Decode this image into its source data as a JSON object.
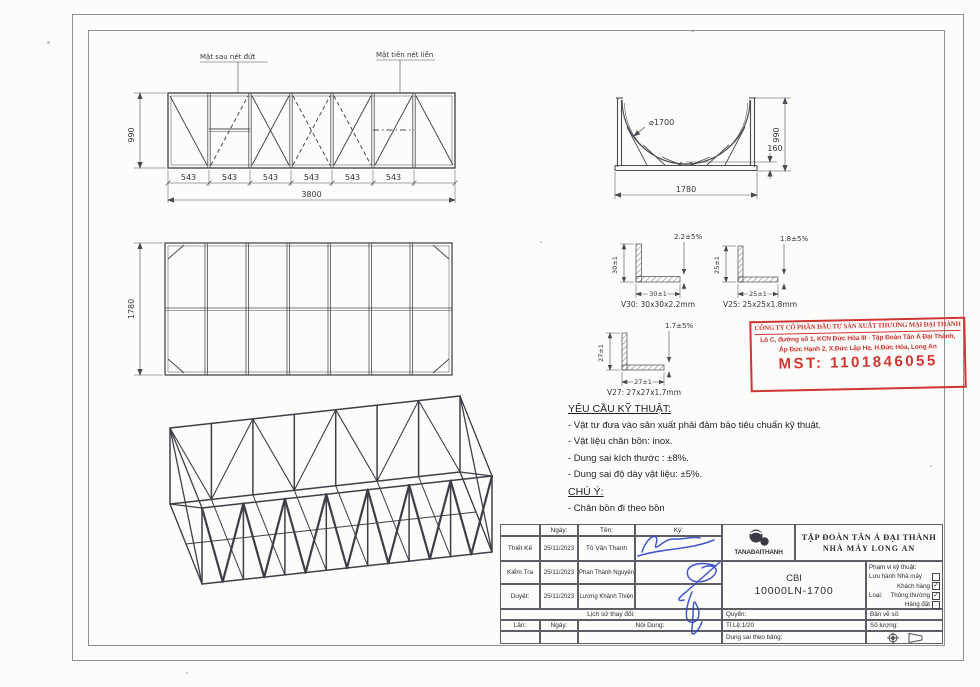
{
  "front_view": {
    "label_back_face": "Mặt sau nét đứt",
    "label_front_face": "Mặt tiền nét liền",
    "dim_height": "990",
    "dim_bays": [
      "543",
      "543",
      "543",
      "543",
      "543",
      "543"
    ],
    "dim_total": "3800"
  },
  "cradle_view": {
    "dim_diameter": "⌀1700",
    "dim_height": "990",
    "dim_offset": "160",
    "dim_width": "1780"
  },
  "plan_view": {
    "dim_depth": "1780"
  },
  "angle_details": {
    "v30": {
      "caption": "V30: 30x30x2.2mm",
      "dim_vertical": "30±1",
      "dim_horizontal": "30±1",
      "dim_thickness": "2.2±5%"
    },
    "v25": {
      "caption": "V25: 25x25x1.8mm",
      "dim_vertical": "25±1",
      "dim_horizontal": "25±1",
      "dim_thickness": "1.8±5%"
    },
    "v27": {
      "caption": "V27: 27x27x1.7mm",
      "dim_vertical": "27±1",
      "dim_horizontal": "27±1",
      "dim_thickness": "1.7±5%"
    }
  },
  "stamp": {
    "company": "CÔNG TY CỔ PHẦN ĐẦU TƯ SẢN XUẤT THƯƠNG MẠI ĐẠI THÀNH",
    "address_line1": "Lô C, đường số 1, KCN Đức Hòa III - Tập Đoàn Tân Á Đại Thành,",
    "address_line2": "Ấp Đức Hạnh 2, X.Đức Lập Hạ, H.Đức Hòa, Long An",
    "tax_id": "MST: 1101846055",
    "color": "#cf3531"
  },
  "tech_requirements": {
    "title": "YÊU CẦU KỸ THUẬT:",
    "items": [
      "- Vật tư đưa vào sản xuất phải đảm bảo tiêu chuẩn kỹ thuật.",
      "- Vật liệu chân bồn: inox.",
      "- Dung sai kích thước : ±8%.",
      "- Dung sai độ dày vật liệu: ±5%."
    ],
    "note_title": "CHÚ Ý:",
    "note_item": "- Chân bồn đi theo bồn"
  },
  "title_block": {
    "columns": {
      "date": "Ngày:",
      "name": "Tên:",
      "sign": "Ký:"
    },
    "approvals": [
      {
        "role": "Thiết Kế",
        "date": "25/11/2023",
        "name": "Tô Văn Thanh"
      },
      {
        "role": "Kiểm Tra",
        "date": "25/11/2023",
        "name": "Phan Thành Nguyên"
      },
      {
        "role": "Duyệt:",
        "date": "25/11/2023",
        "name": "Lương Khánh Thiện"
      }
    ],
    "history_title": "Lịch sử thay đổi:",
    "revision_columns": {
      "lan": "Lần:",
      "ngay": "Ngày:",
      "noi_dung": "Nội Dung:"
    },
    "company": {
      "logo_text": "TANAĐAITHANH",
      "name": "TẬP ĐOÀN TÂN Á ĐẠI THÀNH",
      "factory": "NHÀ MÁY LONG AN"
    },
    "drawing_code": {
      "line1": "CBI",
      "line2": "10000LN-1700"
    },
    "scope": {
      "title": "Phạm vi kỹ thuật:",
      "loai_label": "Loại:",
      "options": [
        {
          "label": "Lưu hành Nhà máy",
          "checked": false
        },
        {
          "label": "Khách hàng",
          "checked": true
        },
        {
          "label": "Thông thường",
          "checked": true
        },
        {
          "label": "Hàng đặt",
          "checked": false
        }
      ]
    },
    "fields": {
      "quyen": "Quyển:",
      "ban_ve_so": "Bản vẽ số:",
      "ti_le": "Tỉ Lệ:1/20",
      "so_luong": "Số lượng:",
      "dung_sai": "Dung sai theo bảng:"
    }
  }
}
